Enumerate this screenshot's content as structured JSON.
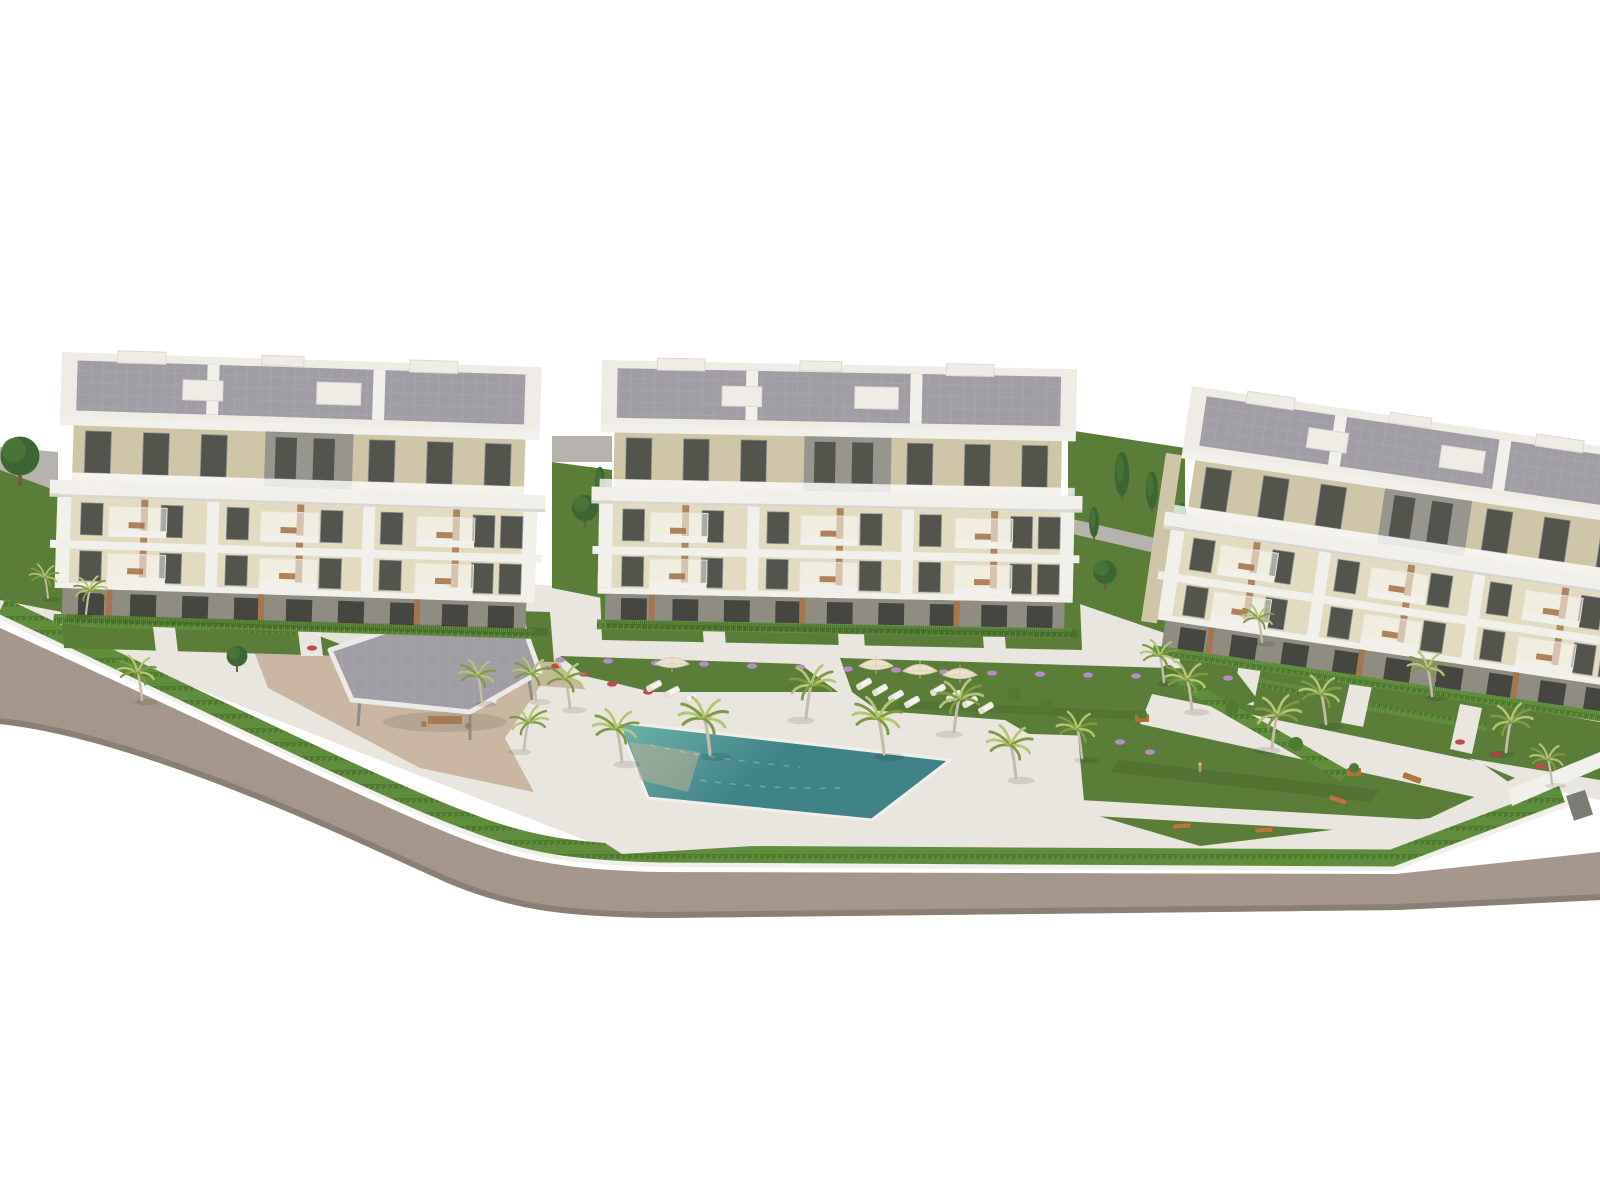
{
  "scene": {
    "title": "Aerial 3D rendering of a residential apartment complex with gardens, palm trees and a swimming pool",
    "type": "architectural-visualization",
    "background": "#ffffff"
  },
  "buildings": [
    {
      "id": "building-left",
      "levels": 4,
      "style": "white frame, cream facade, roof terraces, balconies"
    },
    {
      "id": "building-middle",
      "levels": 4,
      "style": "white frame, cream facade, roof terraces, balconies"
    },
    {
      "id": "building-right",
      "levels": 4,
      "style": "white frame, cream facade, roof terraces, balconies, angled toward lower right"
    }
  ],
  "landscape": {
    "swimming_pools": 1,
    "pergolas": 1,
    "palm_trees": 22,
    "parasols": 4,
    "sun_loungers": 11,
    "garden_benches": 4,
    "planters": 2,
    "cypress_trees": 5,
    "round_trees": 4,
    "perimeter_road": true,
    "perimeter_hedge": true,
    "flower_beds": [
      "purple",
      "red"
    ]
  },
  "palette": {
    "background": "#ffffff",
    "road": "#a4968a",
    "road_edge": "#8a7f73",
    "curb": "#f0efeb",
    "paving_light": "#e9e6df",
    "sand_path": "#cbb7a1",
    "lawn": "#5a7d38",
    "lawn_dark": "#49682c",
    "hedge": "#6b9a44",
    "hedge_dark": "#4f7a30",
    "palm_light": "#b5c573",
    "palm_dark": "#7e9a43",
    "trunk": "#c6bca8",
    "tree_dark": "#3c6631",
    "pool_deep": "#3f8288",
    "pool_light": "#6fb3ac",
    "pool_shallow": "#bfae93",
    "building_white": "#f2f0ea",
    "parapet": "#efece6",
    "roof_gray": "#a09da5",
    "cream": "#e3dbbf",
    "cream_dark": "#cfc6a8",
    "gray_wall": "#98958c",
    "window_dark": "#53544c",
    "glass": "#b9bfc6",
    "wood": "#a5764e",
    "ground_floor": "#8f8c82",
    "umbrella": "#ece2cb",
    "flower_purple": "#b48fc6",
    "flower_red": "#c04b4e",
    "bench": "#b07a3e",
    "wall_gray": "#b5b3ac",
    "gate_gray": "#7b7c76"
  }
}
